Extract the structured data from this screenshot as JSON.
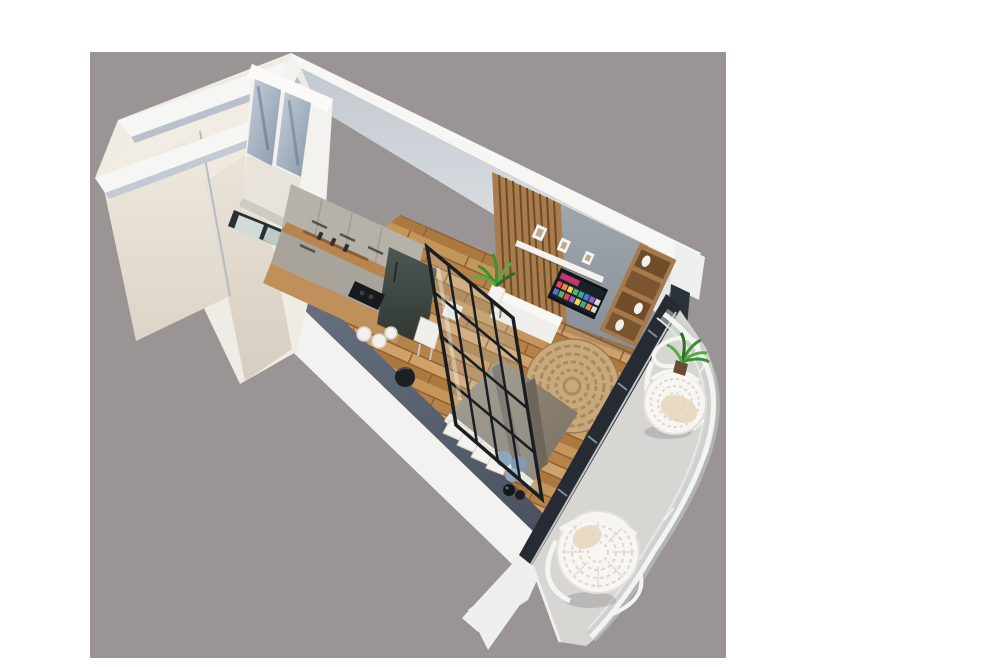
{
  "meta": {
    "title": "3D axonometric render of a studio apartment with balcony",
    "view": "top-down isometric cutaway, rotated diagonally on a gray backdrop",
    "canvas_width": 1000,
    "canvas_height": 667
  },
  "palette": {
    "page_bg": "#ffffff",
    "backdrop": "#9a9495",
    "wall_white": "#f2f2f0",
    "wall_top_white": "#f6f6f4",
    "wall_shadow_blue": "#b9c1cc",
    "cream_floor": "#f2ede4",
    "corridor_floor": "#efe9de",
    "navy_wall": "#59636f",
    "window_frame": "#262b33",
    "partition_frame": "#1a1d22",
    "partition_glass": "rgba(215,228,232,0.20)",
    "wood_floor": "#c49659",
    "wood_floor_dark": "#8d6134",
    "rug": "#c7a97b",
    "rug_ring": "#ab8a5d",
    "kitchen_upper_cabinets": "#b6b1a9",
    "kitchen_lower_cabinets": "#a8a39b",
    "kitchen_backsplash_wood": "#b8854f",
    "counter_wood": "#c0905a",
    "fridge_dark": "#3c453f",
    "cooktop_black": "#17191c",
    "slat_wood": "#a87c4c",
    "slat_line": "#6e4c26",
    "concrete_wall": "#959ba3",
    "shelf_white": "#f3f2ee",
    "tv_frame": "#111419",
    "tv_banner": "#c2366f",
    "tv_tiles": [
      "#e5484d",
      "#f0883e",
      "#f3d34a",
      "#58b368",
      "#3aa6a0",
      "#4678d8",
      "#8a63c9",
      "#d9d9d9"
    ],
    "shelf_unit_wood": "#a5794a",
    "shelf_cubby": "#6f4d2a",
    "bench_white": "#f0efeb",
    "duvet": "#8b8173",
    "duvet_stripe": "#6e665a",
    "bed_edge_white": "#edebe4",
    "pillow": "#f4f2ec",
    "cushion_blue": "#7e96b5",
    "cushion_blue_dark": "#6d87a8",
    "cushion_blue_light": "#90a7c3",
    "vase_black": "#141517",
    "balcony_floor": "#d8d6d3",
    "railing_white": "#f4f4f1",
    "railing_glass": "rgba(198,206,201,0.55)",
    "chair_white": "#f7f6f3",
    "chair_weave": "#dcd7ce",
    "chair_cushion": "#ebdabf",
    "plant_green": "#3f8f33",
    "plant_green_light": "#57ab42",
    "plant_pot_white": "#f4f3f0",
    "plant_pot_brown": "#6b4a33",
    "mirror_blue": "#9fb0c0",
    "door_frame": "#2a2f36",
    "door_glass": "#cfdcd8"
  },
  "scene": {
    "rooms": [
      "entry hall",
      "bathroom with black-framed glass door",
      "kitchen nook",
      "combined living / sleeping room",
      "balcony"
    ],
    "furniture": [
      "tall wardrobe with mirrored doors",
      "greige kitchen cabinets with wooden backsplash",
      "dark fridge column",
      "black cooktop",
      "white bar stools",
      "small black dining table with white chairs",
      "black metal framed glass partition",
      "double bed with taupe duvet and dark runner stripes",
      "white pillows",
      "three round blue cushions",
      "two black floor vases",
      "round jute rug",
      "TV wall with wooden slat panel and concrete finish",
      "floating white shelf with picture frames",
      "wall mounted smart TV with colorful app tiles",
      "white media bench",
      "wooden open shelving unit with white vases",
      "potted green plants",
      "glass balcony railing with white handrail",
      "two white rattan hanging egg chairs"
    ]
  }
}
